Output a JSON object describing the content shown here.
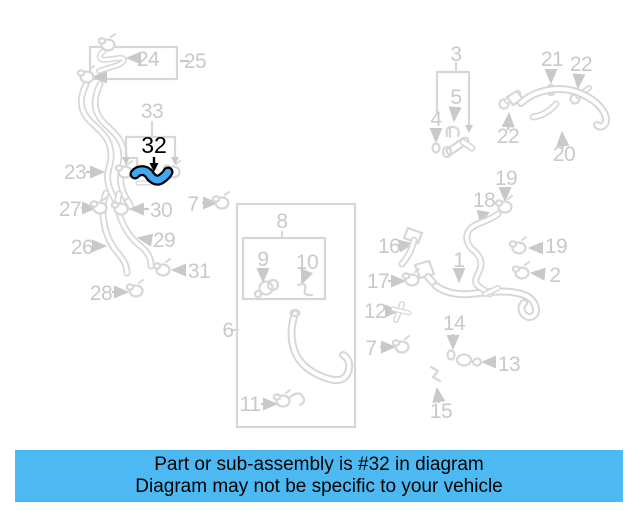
{
  "banner": {
    "line1": "Part or sub-assembly is #32 in diagram",
    "line2": "Diagram may not be specific to your vehicle"
  },
  "highlighted_part": {
    "number": "32"
  },
  "colors": {
    "banner_bg": "#4db9f2",
    "banner_text": "#000000",
    "highlight_fill": "#3fa9f5",
    "highlight_outline": "#000000",
    "line": "#d7d7d7",
    "label": "#c9c9c9",
    "background": "#ffffff"
  },
  "diagram": {
    "labels": {
      "n24": "24",
      "n25": "25",
      "n33": "33",
      "n23": "23",
      "n27": "27",
      "n30": "30",
      "n7a": "7",
      "n26": "26",
      "n29": "29",
      "n31": "31",
      "n28": "28",
      "n8": "8",
      "n9": "9",
      "n10": "10",
      "n6": "6",
      "n11": "11",
      "n3": "3",
      "n5": "5",
      "n4": "4",
      "n21": "21",
      "n22a": "22",
      "n22b": "22",
      "n20": "20",
      "n19a": "19",
      "n18": "18",
      "n16": "16",
      "n19b": "19",
      "n1": "1",
      "n17": "17",
      "n2": "2",
      "n12": "12",
      "n14": "14",
      "n7b": "7",
      "n13": "13",
      "n15": "15"
    }
  }
}
